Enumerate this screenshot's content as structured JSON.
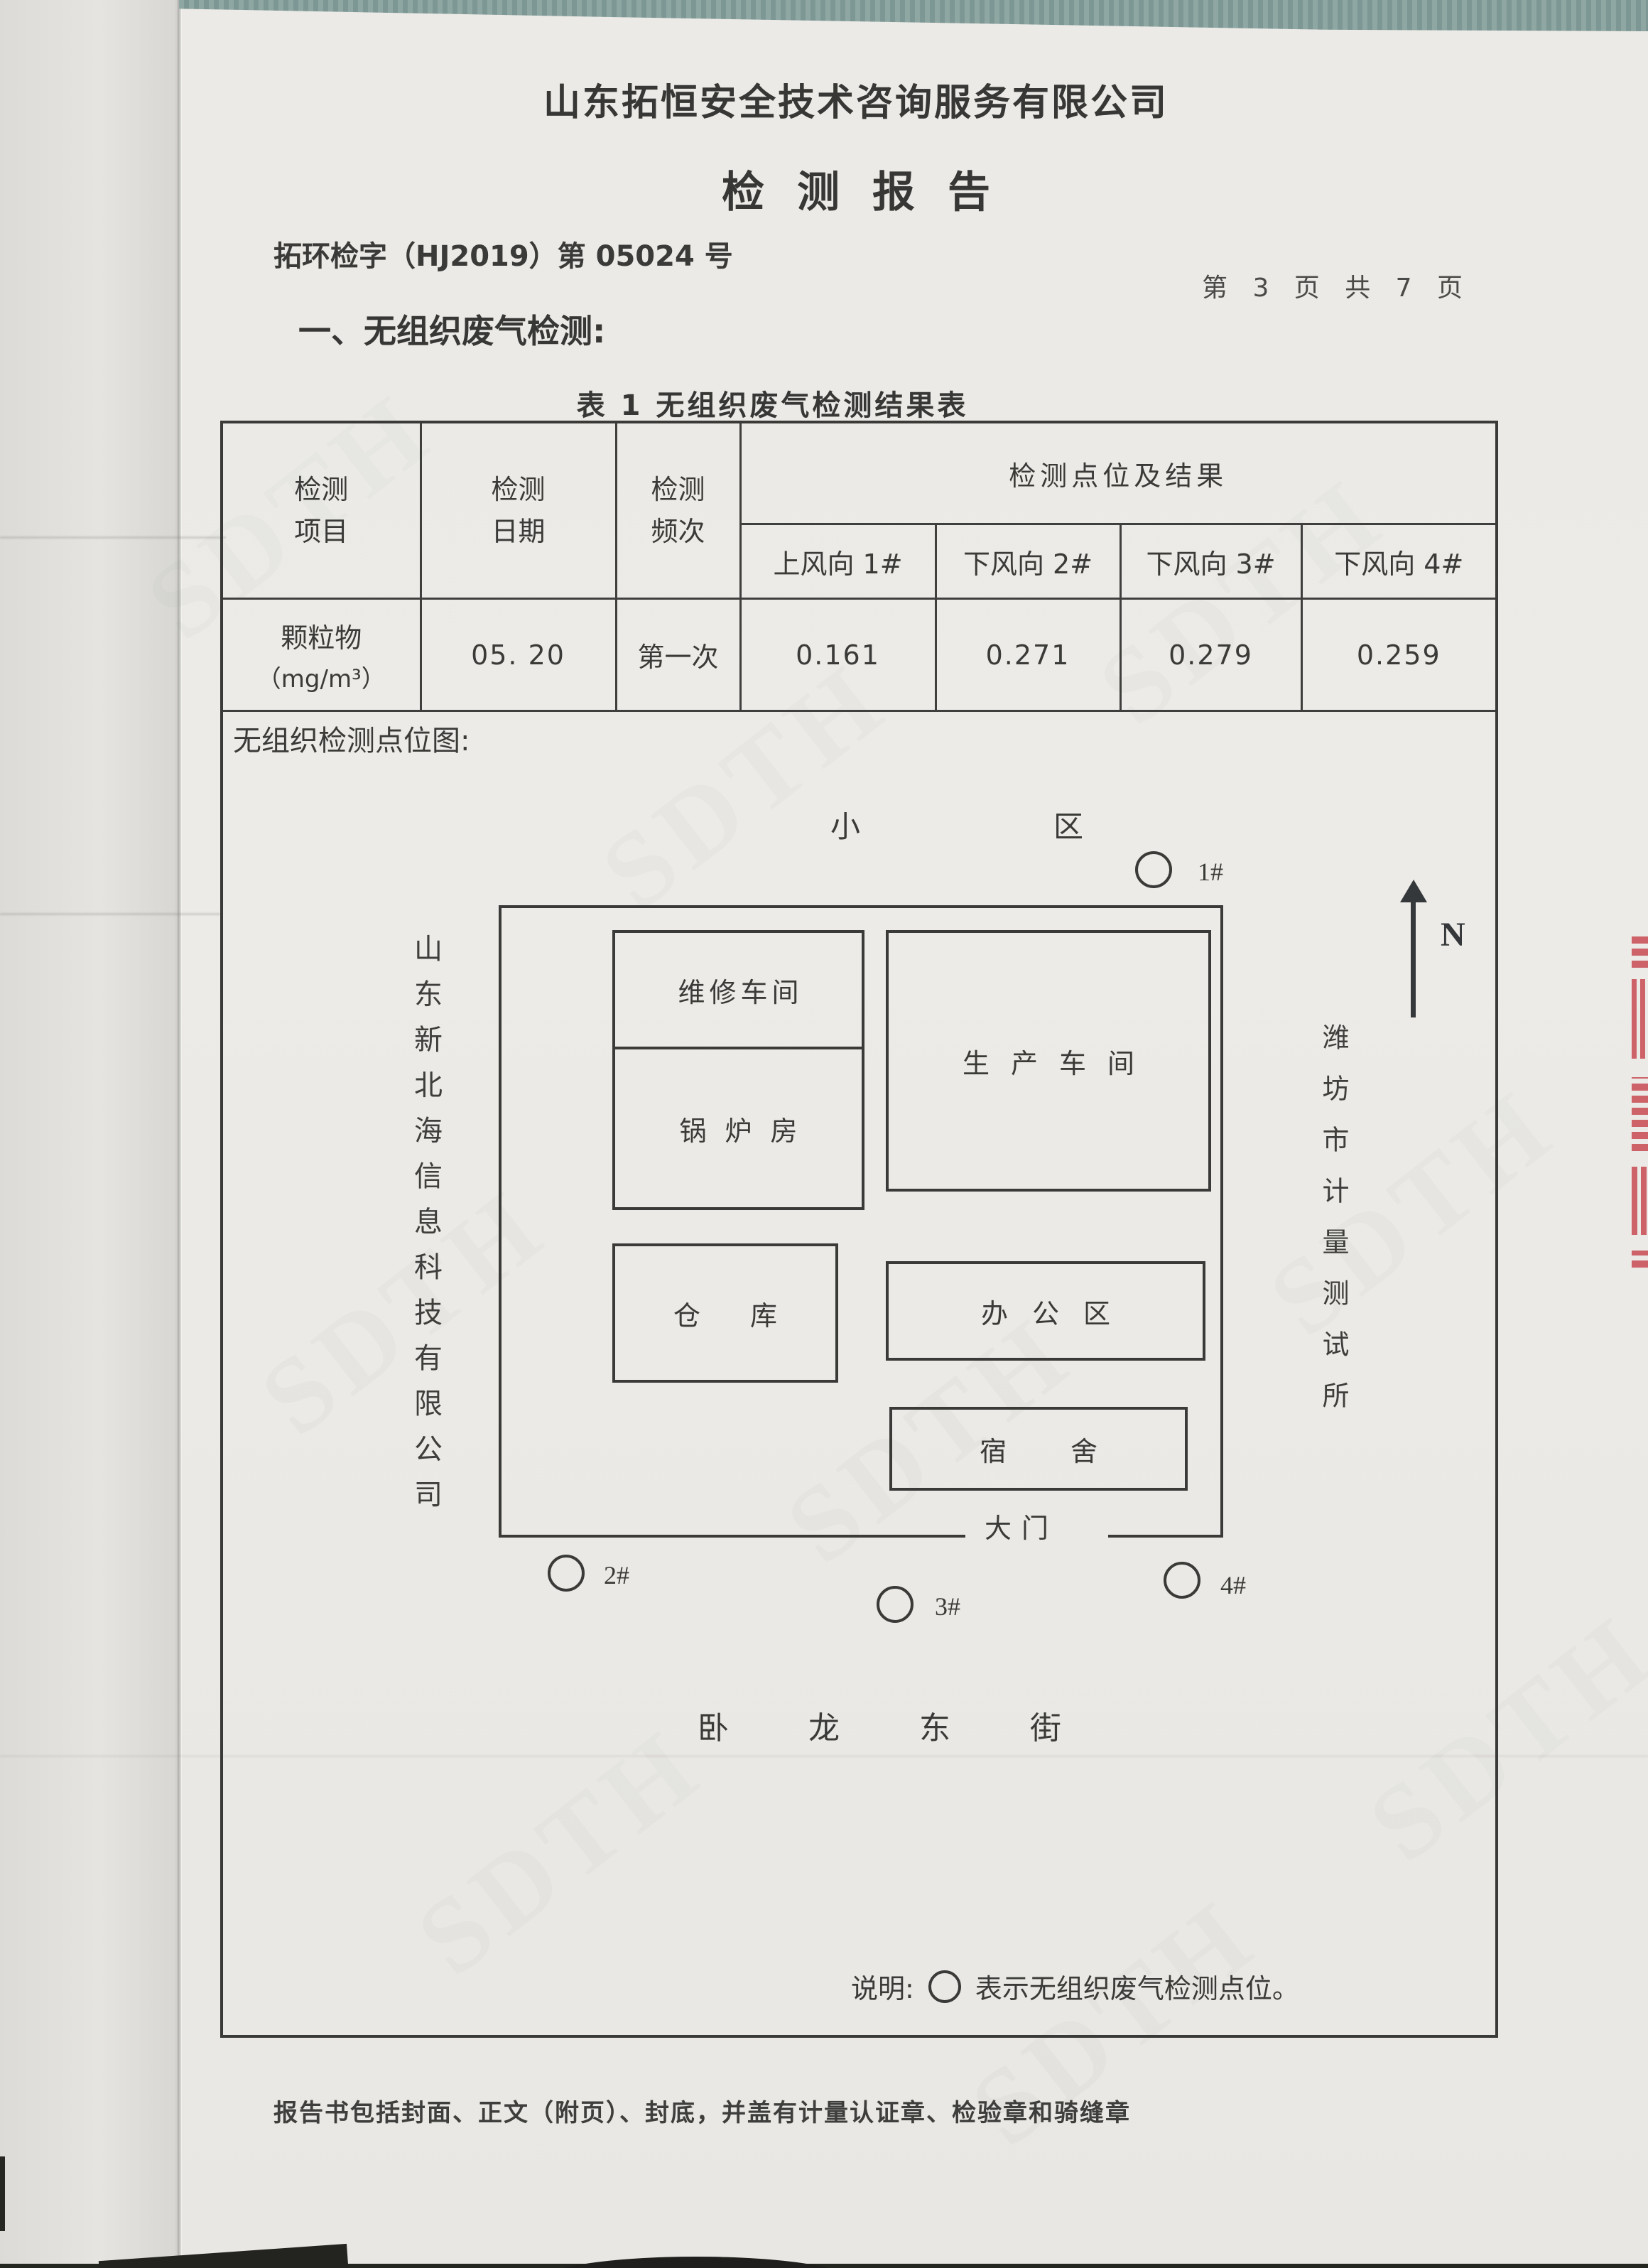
{
  "report": {
    "company_name": "山东拓恒安全技术咨询服务有限公司",
    "title": "检测报告",
    "report_number": "拓环检字（HJ2019）第 05024 号",
    "page_indicator": "第 3 页 共 7 页",
    "section_heading": "一、无组织废气检测:",
    "footer_note": "报告书包括封面、正文（附页）、封底，并盖有计量认证章、检验章和骑缝章",
    "watermark_text": "SDTH"
  },
  "table": {
    "caption": "表 1  无组织废气检测结果表",
    "header": {
      "item": "检测项目",
      "date": "检测日期",
      "frequency": "检测频次",
      "points_group": "检测点位及结果",
      "points": [
        "上风向 1#",
        "下风向 2#",
        "下风向 3#",
        "下风向 4#"
      ]
    },
    "rows": [
      {
        "item": "颗粒物",
        "item_unit": "（mg/m³）",
        "date": "05. 20",
        "frequency": "第一次",
        "values": [
          "0.161",
          "0.271",
          "0.279",
          "0.259"
        ]
      }
    ]
  },
  "diagram": {
    "section_label": "无组织检测点位图:",
    "residential_area_label": "小区",
    "street_label": "卧龙东街",
    "gate_label": "大门",
    "north_label": "N",
    "left_company_vertical": "山东新北海信息科技有限公司",
    "right_org_vertical": "潍坊市计量测试所",
    "buildings": [
      {
        "label": "维修车间"
      },
      {
        "label": "锅炉房"
      },
      {
        "label": "生产车间"
      },
      {
        "label": "仓库"
      },
      {
        "label": "办公区"
      },
      {
        "label": "宿舍"
      }
    ],
    "points": [
      {
        "id": "1#"
      },
      {
        "id": "2#"
      },
      {
        "id": "3#"
      },
      {
        "id": "4#"
      }
    ],
    "legend_label": "说明:",
    "legend_text": "表示无组织废气检测点位。"
  },
  "colors": {
    "paper": "#edece7",
    "ink": "#3a3a38",
    "table_border": "#3f3f3d",
    "seal_red": "#c94f58",
    "fabric_teal": "#8ea7a3"
  }
}
